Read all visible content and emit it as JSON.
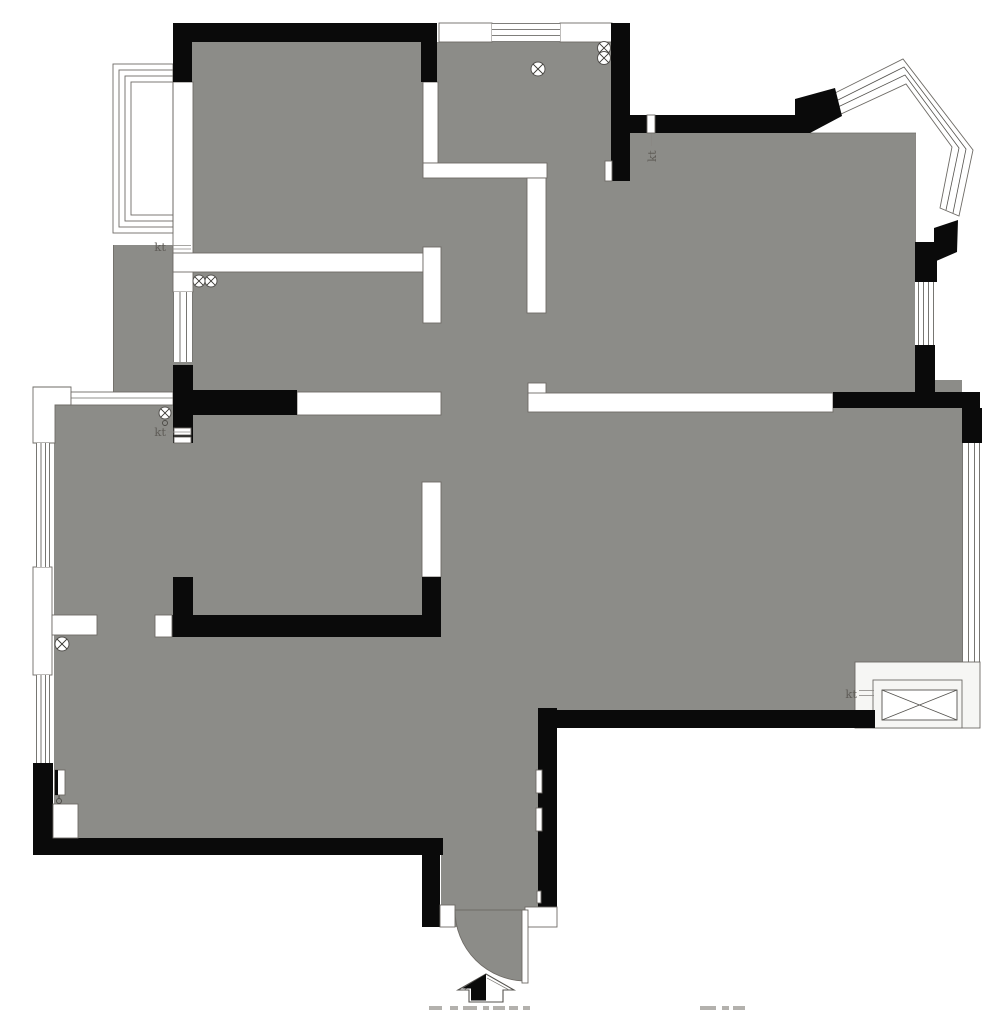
{
  "title": "Apartment floor plan drawing",
  "colors": {
    "floor_gray": "#8c8c88",
    "structural_wall": "#0a0a0a",
    "partition_outline": "#6e6b66",
    "label_text": "#5f5c57",
    "background": "#ffffff"
  },
  "labels": {
    "ac_balcony_left": "kt",
    "ac_mid_left": "kt",
    "ac_top_right": "kt",
    "ac_bottom_right": "kt"
  },
  "symbols": {
    "drain": "circle with X (floor drain)",
    "entrance_arrow": "upward arrow, left half filled",
    "ac_outdoor_unit": "rectangle with diagonal cross",
    "windows": "parallel-line glazing bands",
    "bay_window": "angled 4-line polyline, top right",
    "balcony_window": "nested rectangles, top left",
    "entry_door": "quarter-circle swing arc, bottom center"
  }
}
